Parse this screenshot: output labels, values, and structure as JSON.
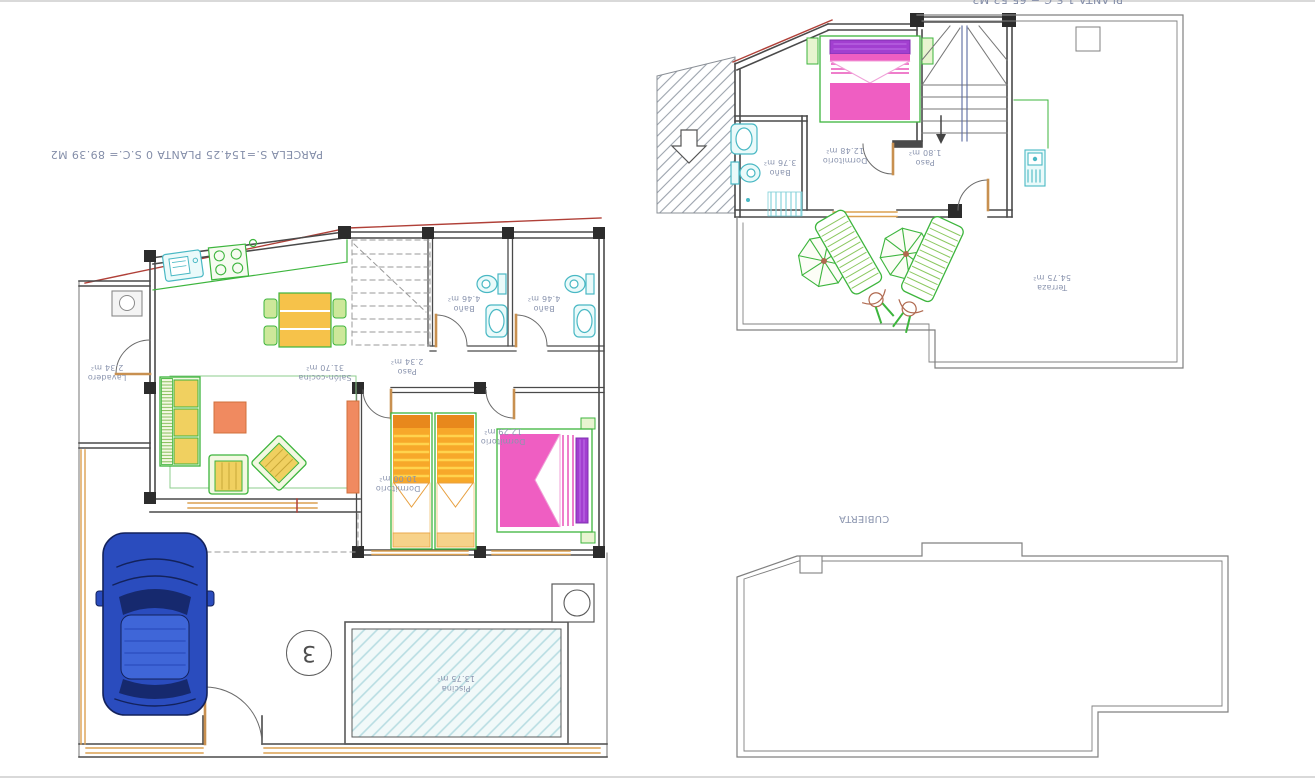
{
  "page": {
    "description": "CAD floor-plan sheet of a villa: ground floor with pool and car, first floor with terrace, roof plan",
    "background": "#ffffff",
    "frame_line_color": "#d9d9d9"
  },
  "colors": {
    "label_text": "#8a94ae",
    "walls": "#4a4a4a",
    "boundary": "#808080",
    "furniture_green": "#3db53d",
    "fixture_cyan": "#49b8c4",
    "window_orange": "#c89050",
    "bed_orange": "#f7a82a",
    "bed_pink": "#ef5ec2",
    "pillow_purple": "#a23fd0",
    "car_blue": "#2a4cbe",
    "roof_line_red": "#b04038",
    "pool_hatch": "#b8dde2"
  },
  "ground_floor": {
    "title": {
      "line1": "PARCELA S.=154.25",
      "line2": "PLANTA 0 S.C.= 89.39 M2"
    },
    "unit_number": "3",
    "rooms": {
      "lavadero": {
        "name": "Lavadero",
        "area": "2.34 m²"
      },
      "salon_cocina": {
        "name": "Salón-cocina",
        "area": "31.70 m²"
      },
      "paso": {
        "name": "Paso",
        "area": "2.34 m²"
      },
      "bano1": {
        "name": "Baño",
        "area": "4.46 m²"
      },
      "bano2": {
        "name": "Baño",
        "area": "4.46 m²"
      },
      "dormitorio1": {
        "name": "Dormitorio",
        "area": "10.00 m²"
      },
      "dormitorio2": {
        "name": "Dormitorio",
        "area": "12.29 m²"
      },
      "piscina": {
        "name": "Piscina",
        "area": "13.75 m²"
      }
    }
  },
  "first_floor": {
    "title_clipped": "PLANTA 1 S.C.= 65.52 M2",
    "rooms": {
      "bano": {
        "name": "Baño",
        "area": "3.76 m²"
      },
      "dormitorio": {
        "name": "Dormitorio",
        "area": "12.48 m²"
      },
      "paso": {
        "name": "Paso",
        "area": "1.80 m²"
      },
      "terraza": {
        "name": "Terraza",
        "area": "54.75 m²"
      }
    }
  },
  "roof": {
    "label": "CUBIERTA"
  }
}
